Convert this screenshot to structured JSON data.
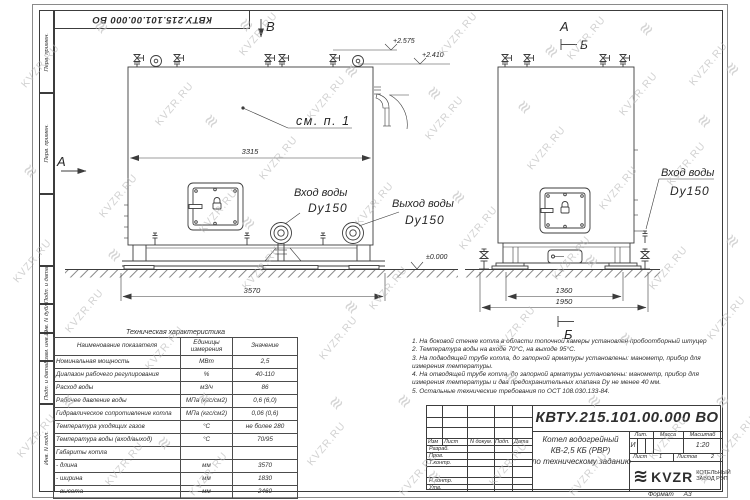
{
  "watermark": {
    "text": "KVZR.RU",
    "logo_glyph": "≋"
  },
  "frame": {
    "stamp_top": "КВТУ.215.101.00.000 ВО",
    "left_labels": [
      "Перв. примен.",
      "Перв. примен.",
      "",
      "Подп. и дата",
      "Инв. N дубл.",
      "Взам. инв. N",
      "Подп. и дата",
      "Инв. N подл."
    ]
  },
  "views": {
    "left": {
      "view_label": "В",
      "side_view_label": "А",
      "callout": "см. п. 1",
      "dim_body": "3315",
      "dim_overall": "3570",
      "elev_top1": "+2.575",
      "elev_top2": "+2.410",
      "elev_ground": "±0.000",
      "inlet_line1": "Вход воды",
      "inlet_line2": "Dy150",
      "outlet_line1": "Выход воды",
      "outlet_line2": "Dy150"
    },
    "right": {
      "view_label": "А",
      "section_label_top": "Б",
      "section_label_bottom": "Б",
      "dim_inner": "1360",
      "dim_overall": "1950",
      "inlet_line1": "Вход воды",
      "inlet_line2": "Dy150"
    }
  },
  "tech_table": {
    "title": "Техническая характеристика",
    "headers": [
      "Наименование показателя",
      "Единицы измерения",
      "Значение"
    ],
    "rows": [
      [
        "Номинальная мощность",
        "МВт",
        "2,5"
      ],
      [
        "Диапазон рабочего регулирования",
        "%",
        "40-110"
      ],
      [
        "Расход воды",
        "м3/ч",
        "86"
      ],
      [
        "Рабочее давление воды",
        "МПа (кгс/см2)",
        "0,6 (6,0)"
      ],
      [
        "Гидравлическое сопротивление котла",
        "МПа (кгс/см2)",
        "0,06 (0,6)"
      ],
      [
        "Температура уходящих газов",
        "°С",
        "не более 280"
      ],
      [
        "Температура воды (вход/выход)",
        "°С",
        "70/95"
      ],
      [
        "Габариты котла",
        "",
        ""
      ],
      [
        "   - длина",
        "мм",
        "3570"
      ],
      [
        "   - ширина",
        "мм",
        "1830"
      ],
      [
        "   - высота",
        "мм",
        "2460"
      ]
    ]
  },
  "notes": [
    "1. На боковой стенке котла в области топочной камеры установлен пробоотборный штуцер",
    "2. Температура воды на входе 70°С, на выходе 95°С.",
    "3. На подводящей трубе котла, до запорной арматуры установлены: манометр, прибор для",
    "измерения температуры.",
    "4. На отводящей трубе котла, до запорной арматуры установлены: манометр, прибор для",
    "измерения температуры и два предохранительных клапана Dу не менее 40 мм.",
    "5. Остальные технические требования по ОСТ 108.030.133-84."
  ],
  "title_block": {
    "doc_number": "КВТУ.215.101.00.000 ВО",
    "title_line1": "Котел водогрейный",
    "title_line2": "КВ-2,5 КБ (РВР)",
    "title_line3": "по техническому заданию",
    "header_row": [
      "Изм",
      "Лист",
      "N докум.",
      "Подп.",
      "Дата"
    ],
    "row_razrab": "Разраб.",
    "row_prov": "Пров.",
    "row_tkontr": "Т.контр.",
    "row_nkontr": "Н.контр.",
    "row_utv": "Утв.",
    "lit_header": "Лит.",
    "mass_header": "Масса",
    "scale_header": "Масштаб",
    "lit_value": "И",
    "scale_value": "1:20",
    "sheet_label": "Лист",
    "sheet_value": "1",
    "sheets_label": "Листов",
    "sheets_value": "2",
    "company_logo_text": "KVZR",
    "company_line1": "КОТЕЛЬНЫЙ",
    "company_line2": "ЗАВОД РЭП",
    "format_label": "Формат",
    "format_value": "А3"
  }
}
